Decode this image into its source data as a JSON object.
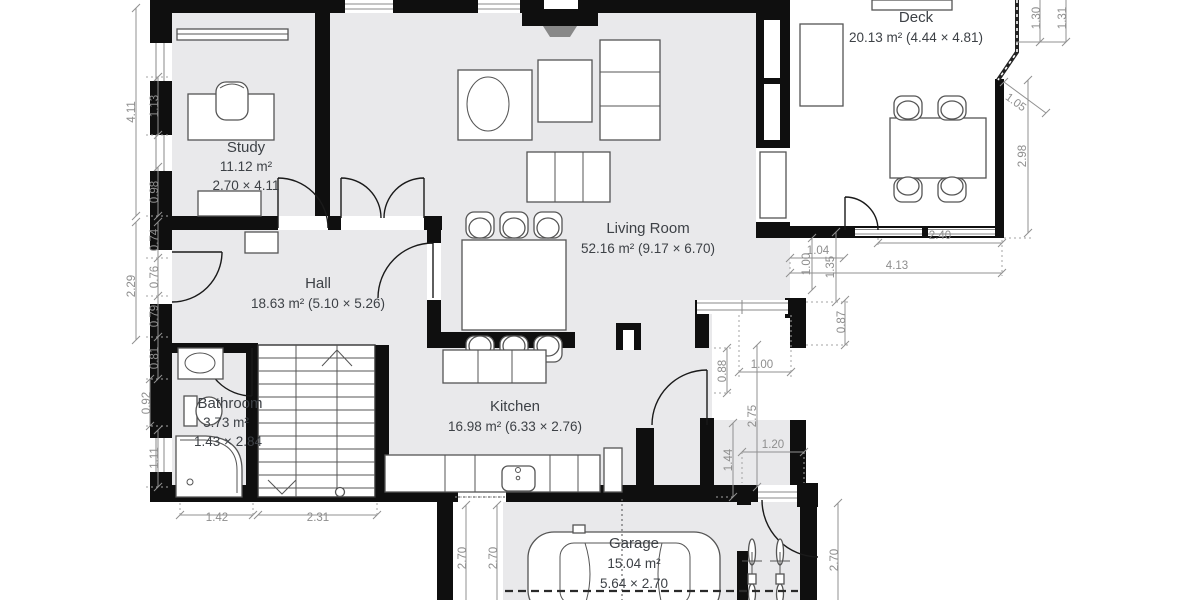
{
  "plan_title": "floor-plan",
  "colors": {
    "wall": "#0f0f0f",
    "floor": "#e9e9eb",
    "dimension_text": "#8e8e8e",
    "room_label": "#3d4146"
  },
  "rooms": {
    "study": {
      "name": "Study",
      "area": "11.12 m²",
      "size": "2.70 × 4.11"
    },
    "hall": {
      "name": "Hall",
      "info": "18.63 m² (5.10 × 5.26)"
    },
    "living": {
      "name": "Living Room",
      "info": "52.16 m² (9.17 × 6.70)"
    },
    "deck": {
      "name": "Deck",
      "info": "20.13 m² (4.44 × 4.81)"
    },
    "bathroom": {
      "name": "Bathroom",
      "area": "3.73 m²",
      "size": "1.43 × 2.84"
    },
    "kitchen": {
      "name": "Kitchen",
      "info": "16.98 m² (6.33 × 2.76)"
    },
    "garage": {
      "name": "Garage",
      "area": "15.04 m²",
      "size": "5.64 × 2.70"
    }
  },
  "dims": {
    "left_outer_1": "4.11",
    "left_outer_2": "2.29",
    "left_1": "1.13",
    "left_2": "0.98",
    "left_3": "0.74",
    "left_4": "0.76",
    "left_5": "0.79",
    "left_6": "0.81",
    "left_7": "0.92",
    "left_8": "1.11",
    "bottom_1": "1.42",
    "bottom_2": "2.31",
    "garage_left_1": "2.70",
    "garage_left_2": "2.70",
    "garage_right": "2.70",
    "top_right_1": "1.30",
    "top_right_2": "1.31",
    "deck_diag": "1.05",
    "deck_right": "2.98",
    "deck_w1": "2.40",
    "deck_w2": "4.13",
    "step_1": "1.04",
    "step_2": "1.00",
    "step_3": "1.35",
    "step_4": "0.87",
    "win_1": "1.00",
    "notch_1": "0.88",
    "notch_2": "2.75",
    "notch_3": "1.44",
    "notch_4": "1.20"
  }
}
